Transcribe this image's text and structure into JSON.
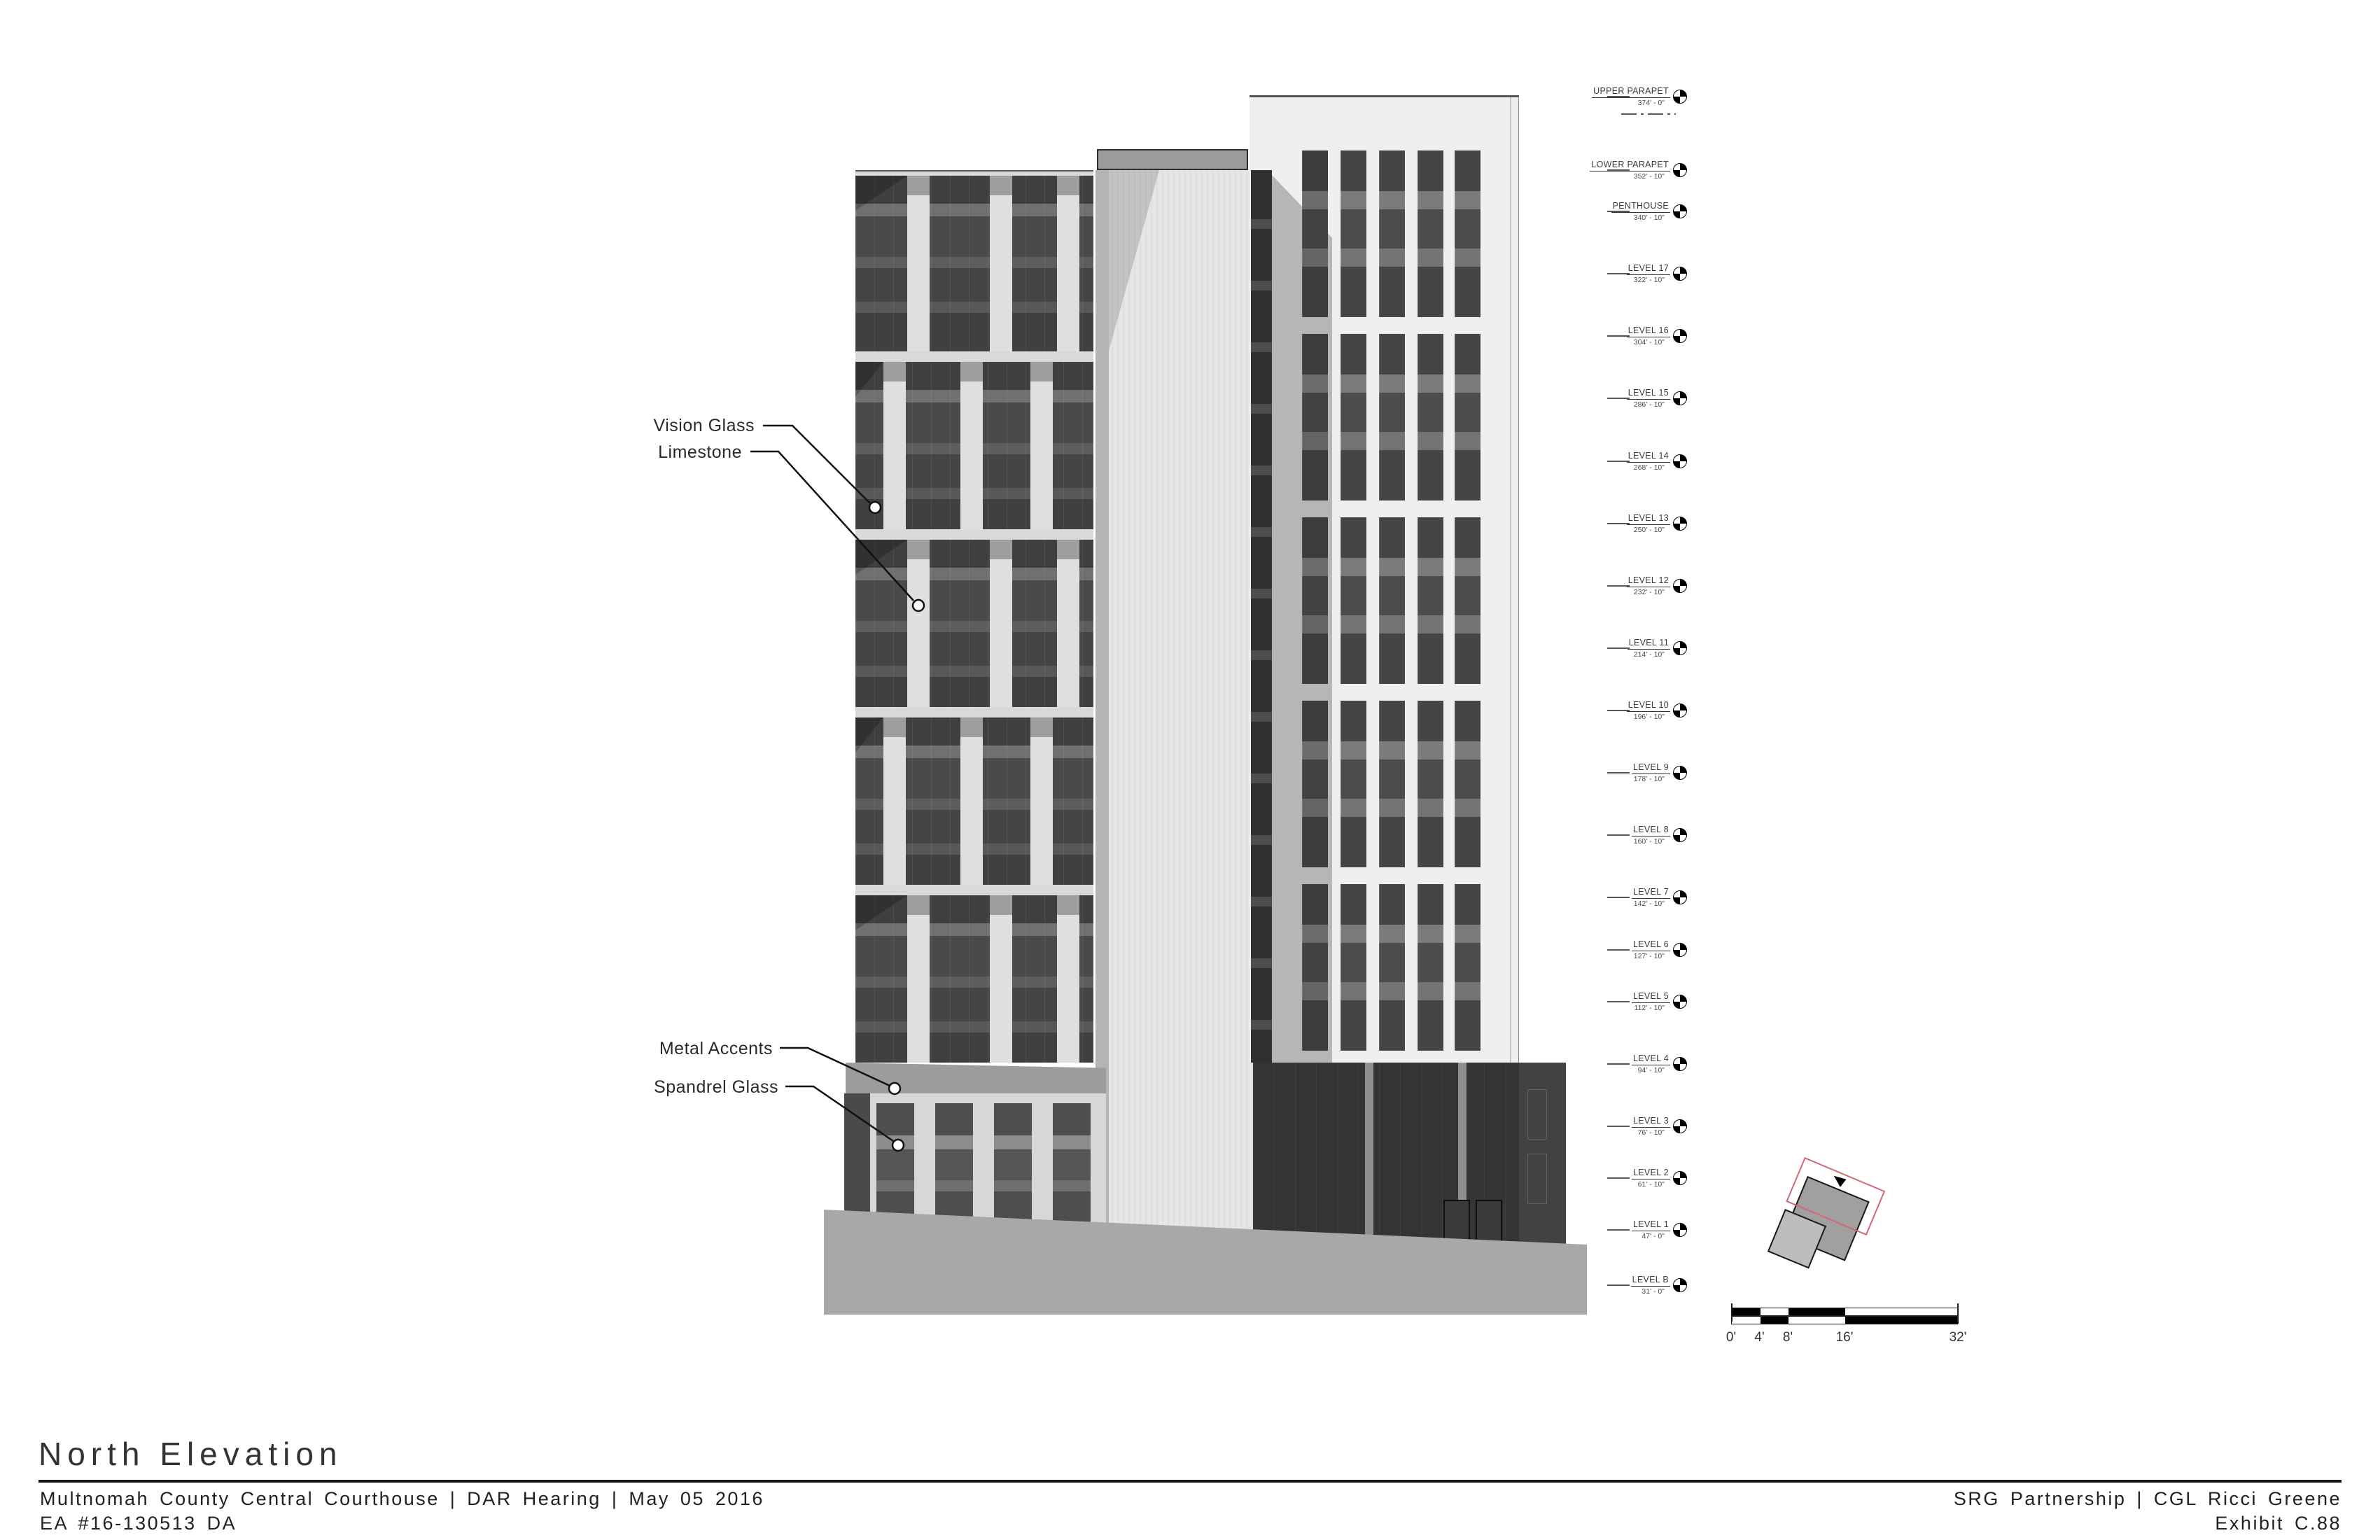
{
  "title_block": {
    "drawing_title": "North Elevation",
    "project_line": "Multnomah County Central Courthouse | DAR Hearing | May 05 2016",
    "case_line": "EA #16-130513 DA",
    "firm_line": "SRG Partnership | CGL Ricci Greene",
    "exhibit_line": "Exhibit C.88"
  },
  "material_annotations": [
    {
      "label": "Vision Glass"
    },
    {
      "label": "Limestone"
    },
    {
      "label": "Metal Accents"
    },
    {
      "label": "Spandrel Glass"
    }
  ],
  "levels": [
    {
      "name": "UPPER PARAPET",
      "elevation": "374' - 0\""
    },
    {
      "name": "LOWER PARAPET",
      "elevation": "352' - 10\""
    },
    {
      "name": "PENTHOUSE",
      "elevation": "340' - 10\""
    },
    {
      "name": "LEVEL 17",
      "elevation": "322' - 10\""
    },
    {
      "name": "LEVEL 16",
      "elevation": "304' - 10\""
    },
    {
      "name": "LEVEL 15",
      "elevation": "286' - 10\""
    },
    {
      "name": "LEVEL 14",
      "elevation": "268' - 10\""
    },
    {
      "name": "LEVEL 13",
      "elevation": "250' - 10\""
    },
    {
      "name": "LEVEL 12",
      "elevation": "232' - 10\""
    },
    {
      "name": "LEVEL 11",
      "elevation": "214' - 10\""
    },
    {
      "name": "LEVEL 10",
      "elevation": "196' - 10\""
    },
    {
      "name": "LEVEL 9",
      "elevation": "178' - 10\""
    },
    {
      "name": "LEVEL 8",
      "elevation": "160' - 10\""
    },
    {
      "name": "LEVEL 7",
      "elevation": "142' - 10\""
    },
    {
      "name": "LEVEL 6",
      "elevation": "127' - 10\""
    },
    {
      "name": "LEVEL 5",
      "elevation": "112' - 10\""
    },
    {
      "name": "LEVEL 4",
      "elevation": "94' - 10\""
    },
    {
      "name": "LEVEL 3",
      "elevation": "76' - 10\""
    },
    {
      "name": "LEVEL 2",
      "elevation": "61' - 10\""
    },
    {
      "name": "LEVEL 1",
      "elevation": "47' - 0\""
    },
    {
      "name": "LEVEL B",
      "elevation": "31' - 0\""
    }
  ],
  "scale_bar": {
    "tick_labels": [
      "0'",
      "4'",
      "8'",
      "16'",
      "32'"
    ]
  },
  "colors": {
    "vision_glass": "#474747",
    "limestone": "#dfdfdf",
    "metal_accent": "#9c9c9c",
    "spandrel_glass": "#4e4e4e",
    "mid_tower_face": "#e6e6e6",
    "ground": "#a8a8a8",
    "site_outline_red": "#cf6a76"
  }
}
